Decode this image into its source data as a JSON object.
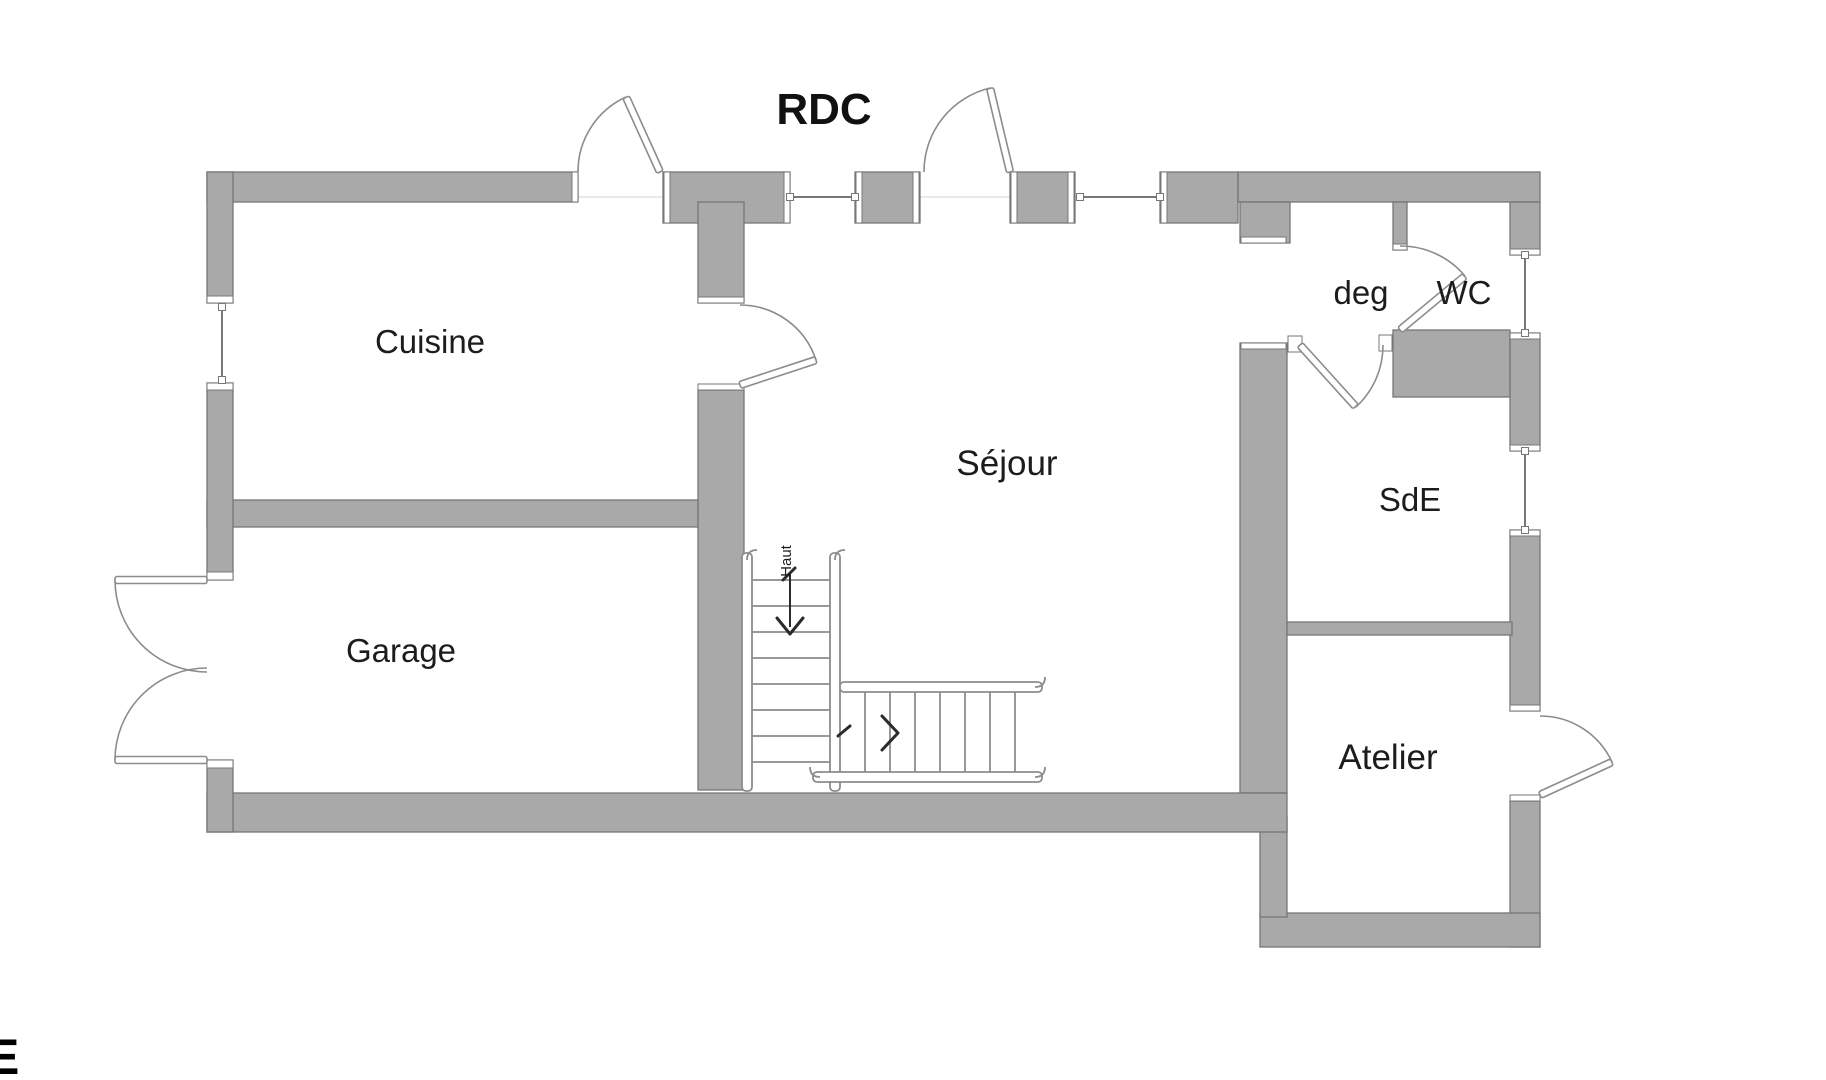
{
  "title": "RDC",
  "floor_plan": {
    "rooms": [
      {
        "id": "cuisine",
        "label": "Cuisine"
      },
      {
        "id": "garage",
        "label": "Garage"
      },
      {
        "id": "sejour",
        "label": "Séjour"
      },
      {
        "id": "deg",
        "label": "deg"
      },
      {
        "id": "wc",
        "label": "WC"
      },
      {
        "id": "sde",
        "label": "SdE"
      },
      {
        "id": "atelier",
        "label": "Atelier"
      }
    ],
    "stairs": {
      "direction_label": "Haut"
    },
    "clipped_text": "E"
  },
  "colors": {
    "wall_fill": "#a9a9a9",
    "wall_stroke": "#777777",
    "line": "#8c8c8c",
    "text": "#1c1c1c",
    "bg": "#ffffff"
  }
}
